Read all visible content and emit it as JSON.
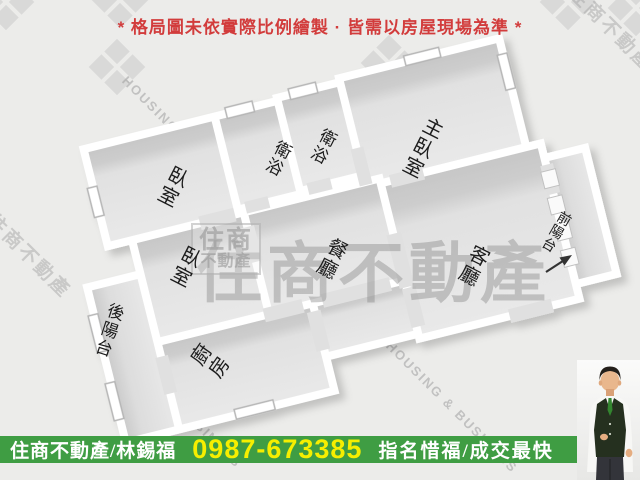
{
  "disclaimer": "* 格局圖未依實際比例繪製 · 皆需以房屋現場為準 *",
  "floorplan": {
    "rooms": [
      {
        "name": "master-bedroom",
        "label": "主臥室"
      },
      {
        "name": "bathroom-1",
        "label": "衛浴"
      },
      {
        "name": "bathroom-2",
        "label": "衛浴"
      },
      {
        "name": "bedroom-1",
        "label": "臥室"
      },
      {
        "name": "bedroom-2",
        "label": "臥室"
      },
      {
        "name": "dining-room",
        "label": "餐廳"
      },
      {
        "name": "living-room",
        "label": "客廳"
      },
      {
        "name": "kitchen",
        "label": "廚房"
      },
      {
        "name": "rear-balcony",
        "label": "後陽台"
      },
      {
        "name": "front-balcony",
        "label": "前陽台"
      }
    ]
  },
  "watermark": {
    "brand": "住商不動產",
    "logo_top": "住商",
    "logo_bottom": "不動產",
    "diagonal_en": "HOUSING & BUSINESS"
  },
  "footer": {
    "agency_agent": "住商不動產/林錫福",
    "phone": "0987-673385",
    "slogan": "指名惜福/成交最快"
  },
  "colors": {
    "banner_green": "#3f9d43",
    "phone_yellow": "#f6ee00",
    "disclaimer_red": "#d23c3c"
  }
}
